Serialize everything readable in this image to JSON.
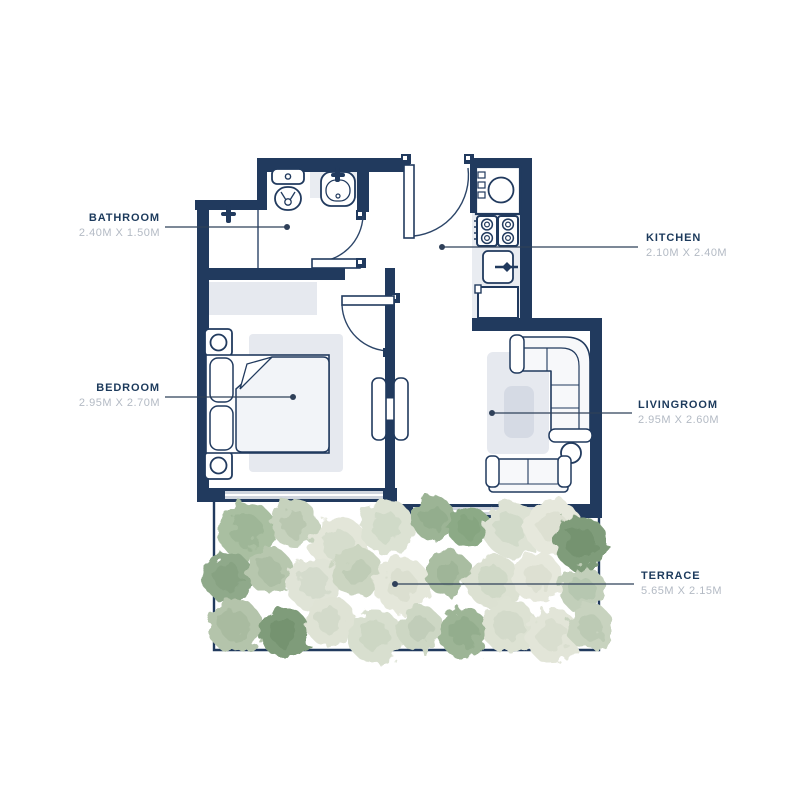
{
  "title": "apartment-floor-plan",
  "colors": {
    "wall": "#213a5e",
    "fixture_outline": "#2c4568",
    "fixture_fill": "#f7f8fa",
    "soft_gray_fill": "#e6e9ef",
    "counter_fill": "#e9ecf1",
    "coffee_table_fill": "#d5dae4",
    "window_band": "#cfd5de",
    "label_text": "#1c3a5c",
    "dims_text": "#b3bac4",
    "leader_line": "#2f4059",
    "tree_greens": [
      "#7f9c7a",
      "#9cb495",
      "#b4c4ab",
      "#cbd5c1",
      "#dde2d4",
      "#e6e8dc"
    ]
  },
  "rooms": [
    {
      "id": "bathroom",
      "name": "BATHROOM",
      "dims": "2.40M X 1.50M"
    },
    {
      "id": "kitchen",
      "name": "KITCHEN",
      "dims": "2.10M X 2.40M"
    },
    {
      "id": "bedroom",
      "name": "BEDROOM",
      "dims": "2.95M X 2.70M"
    },
    {
      "id": "livingroom",
      "name": "LIVINGROOM",
      "dims": "2.95M X 2.60M"
    },
    {
      "id": "terrace",
      "name": "TERRACE",
      "dims": "5.65M X 2.15M"
    }
  ],
  "fixtures": [
    "toilet",
    "bathroom-sink",
    "shower-tap",
    "entrance-door",
    "bathroom-door",
    "washing-machine",
    "stove-4-burners",
    "kitchen-sink",
    "fridge",
    "wardrobe",
    "double-bed",
    "nightstand-lamp",
    "bedroom-rug",
    "bedroom-door",
    "balcony-double-door",
    "l-shaped-sofa",
    "two-seat-sofa",
    "side-table",
    "living-rug",
    "coffee-table",
    "window",
    "terrace-trees"
  ]
}
